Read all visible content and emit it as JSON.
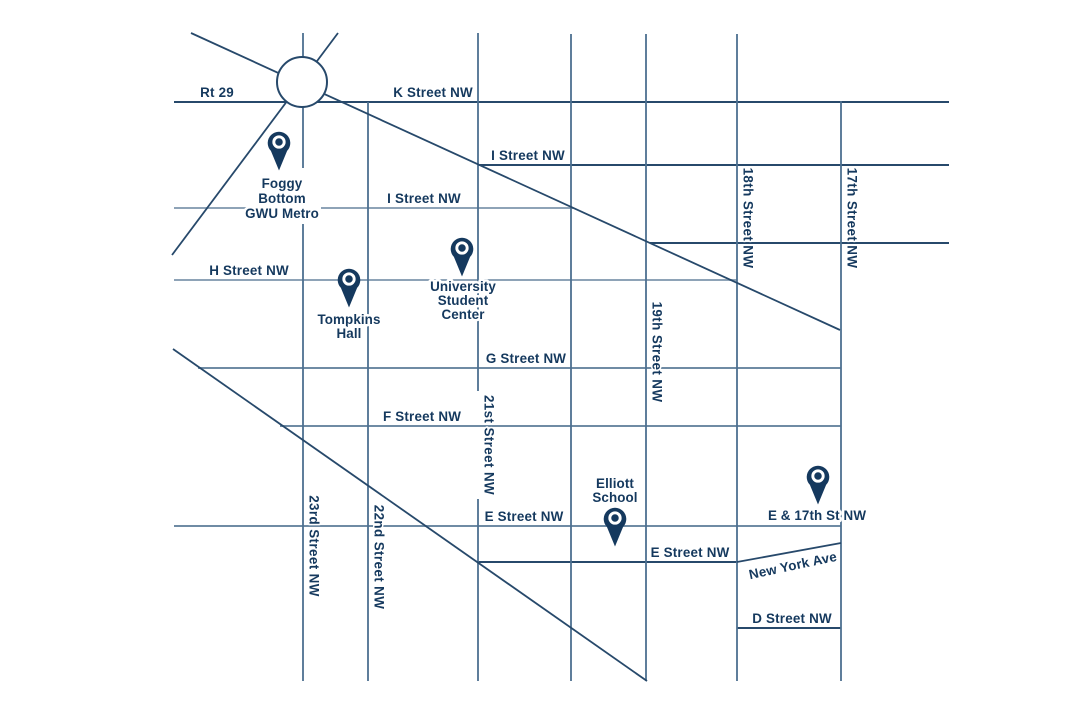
{
  "colors": {
    "ink": "#15395e",
    "line_dark": "#27496b",
    "line_mid": "#6f8ba4",
    "line_light": "#8ea3b7",
    "line_vert": "#4d7090",
    "pin": "#15395e",
    "bg": "#ffffff"
  },
  "streets": {
    "rt29": "Rt 29",
    "k": "K Street NW",
    "i_upper": "I Street NW",
    "i_lower": "I Street NW",
    "h": "H Street NW",
    "g": "G Street NW",
    "f": "F Street NW",
    "e_upper": "E Street NW",
    "e_lower": "E Street NW",
    "d": "D Street NW",
    "new_york": "New York Ave",
    "st23": "23rd Street NW",
    "st22": "22nd Street NW",
    "st21": "21st Street NW",
    "st19": "19th Street NW",
    "st18": "18th Street NW",
    "st17": "17th Street NW"
  },
  "pins": {
    "foggy_bottom": {
      "lines": [
        "Foggy",
        "Bottom",
        "GWU Metro"
      ]
    },
    "tompkins": {
      "lines": [
        "Tompkins",
        "Hall"
      ]
    },
    "student_center": {
      "lines": [
        "University",
        "Student",
        "Center"
      ]
    },
    "elliott": {
      "lines": [
        "Elliott",
        "School"
      ]
    },
    "e_17th": {
      "lines": [
        "E & 17th St NW"
      ]
    }
  }
}
